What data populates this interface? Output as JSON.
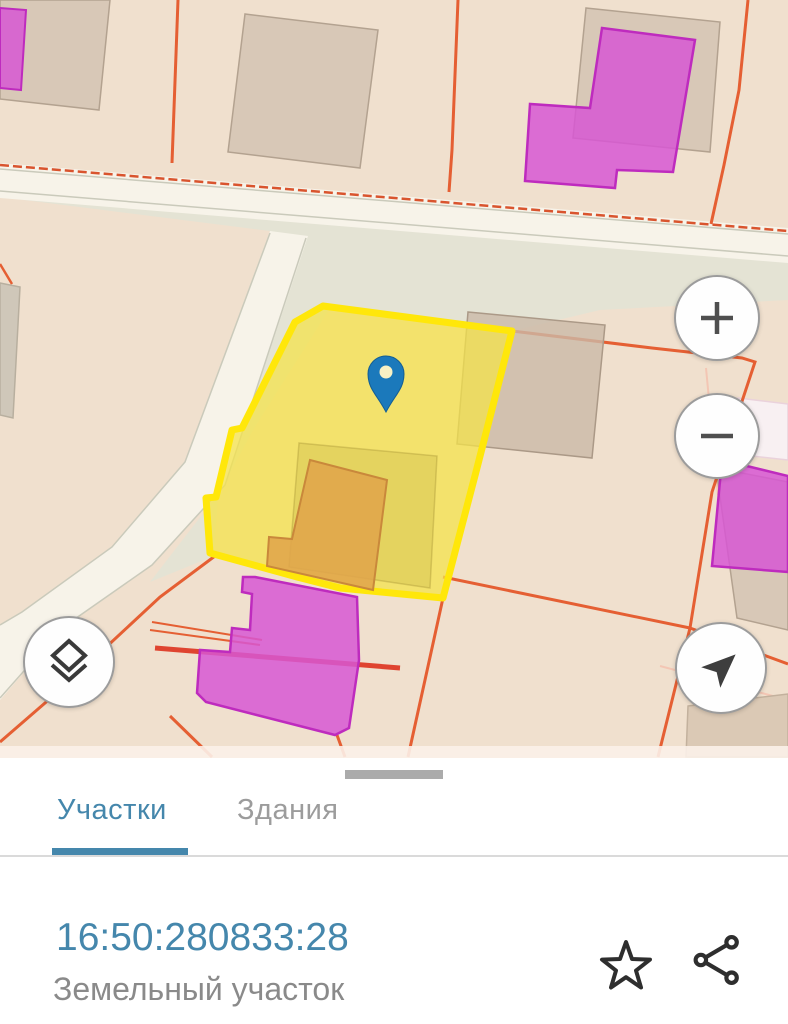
{
  "map": {
    "type": "cadastral-map",
    "selected_parcel": {
      "cadastral_number": "16:50:280833:28",
      "highlight_color": "#FFE70A"
    },
    "pin": {
      "icon": "map-pin-icon",
      "color": "#1B79BB"
    },
    "controls": {
      "zoom_in": {
        "icon": "plus-icon"
      },
      "zoom_out": {
        "icon": "minus-icon"
      },
      "layers": {
        "icon": "layers-icon"
      },
      "compass": {
        "icon": "navigation-arrow-icon"
      }
    },
    "palette": {
      "parcel_beige": "#F0E0CE",
      "road_fill": "#F7F3E9",
      "green_gray_area": "#E4E3D4",
      "boundary_orange": "#E55F33",
      "building_gray": "#D2C2B1",
      "building_magenta": "#D757D4",
      "building_orange": "#E0A54B"
    }
  },
  "bottom_sheet": {
    "tabs": [
      {
        "label": "Участки",
        "active": true
      },
      {
        "label": "Здания",
        "active": false
      }
    ],
    "accent_color": "#4587AC",
    "parcel": {
      "cadastral_number": "16:50:280833:28",
      "type_label": "Земельный участок"
    },
    "actions": [
      {
        "name": "favorite",
        "icon": "star-icon"
      },
      {
        "name": "share",
        "icon": "share-icon"
      }
    ]
  }
}
